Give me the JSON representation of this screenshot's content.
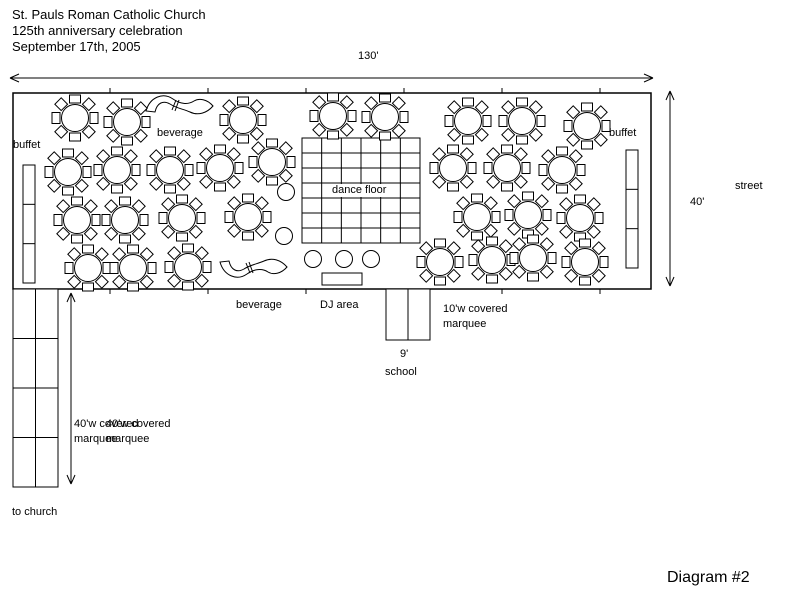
{
  "title": {
    "line1": "St. Pauls Roman Catholic Church",
    "line2": "125th anniversary celebration",
    "line3": "September 17th, 2005"
  },
  "labels": {
    "width_dimension": "130'",
    "height_dimension": "40'",
    "street": "street",
    "buffet_left": "buffet",
    "buffet_right": "buffet",
    "beverage_top": "beverage",
    "beverage_bottom": "beverage",
    "dance_floor": "dance floor",
    "dj_area": "DJ area",
    "marquee10_line1": "10'w covered",
    "marquee10_line2": "marquee",
    "school_width": "9'",
    "school": "school",
    "marquee40_line1": "40'w covered",
    "marquee40_line2": "marquee",
    "to_church": "to church",
    "diagram_number": "Diagram #2"
  },
  "colors": {
    "ink": "#000000",
    "background": "#ffffff"
  },
  "diagram": {
    "main_rect": {
      "x": 13,
      "y": 93,
      "w": 638,
      "h": 196
    },
    "edge_ticks_x": [
      110,
      208,
      306,
      404,
      502,
      600
    ],
    "dance_floor_grid": {
      "x": 302,
      "y": 138,
      "w": 118,
      "h": 105,
      "cols": 6,
      "rows": 7
    },
    "buffet_left_rect": {
      "x": 23,
      "y": 165,
      "w": 12,
      "h": 118,
      "rows": 3,
      "cols": 1
    },
    "buffet_right_rect": {
      "x": 626,
      "y": 150,
      "w": 12,
      "h": 118,
      "rows": 3,
      "cols": 1
    },
    "marquee40_rect": {
      "x": 13,
      "y": 289,
      "w": 45,
      "h": 198,
      "rows": 4,
      "cols": 2
    },
    "school_rect": {
      "x": 386,
      "y": 289,
      "w": 44,
      "h": 51,
      "rows": 1,
      "cols": 2
    },
    "dj_rect": {
      "x": 322,
      "y": 273,
      "w": 40,
      "h": 12
    },
    "tables": [
      [
        75,
        118
      ],
      [
        127,
        122
      ],
      [
        243,
        120
      ],
      [
        333,
        116
      ],
      [
        385,
        117
      ],
      [
        468,
        121
      ],
      [
        522,
        121
      ],
      [
        587,
        126
      ],
      [
        68,
        172
      ],
      [
        117,
        170
      ],
      [
        170,
        170
      ],
      [
        220,
        168
      ],
      [
        272,
        162
      ],
      [
        453,
        168
      ],
      [
        507,
        168
      ],
      [
        562,
        170
      ],
      [
        77,
        220
      ],
      [
        125,
        220
      ],
      [
        182,
        218
      ],
      [
        248,
        217
      ],
      [
        477,
        217
      ],
      [
        528,
        215
      ],
      [
        580,
        218
      ],
      [
        88,
        268
      ],
      [
        133,
        268
      ],
      [
        188,
        267
      ],
      [
        440,
        262
      ],
      [
        492,
        260
      ],
      [
        533,
        258
      ],
      [
        585,
        262
      ]
    ],
    "small_circles": [
      [
        286,
        192
      ],
      [
        284,
        236
      ],
      [
        313,
        259
      ],
      [
        344,
        259
      ],
      [
        371,
        259
      ]
    ],
    "serpentine_path": "M146,111 C150,97 163,92 173,99 C180,104 188,105 194,101 C199,98 207,99 213,106 C207,113 198,116 190,112 C183,109 176,108 170,104 C163,100 157,103 155,112 Z",
    "serpentine_joints": [
      [
        176,
        100,
        172,
        110
      ],
      [
        179,
        100,
        175,
        111
      ]
    ],
    "serpentine_transforms": [
      "",
      "translate(74,373) scale(1,-1)"
    ],
    "arrows": [
      {
        "x1": 10,
        "y1": 78,
        "x2": 653,
        "y2": 78
      },
      {
        "x1": 670,
        "y1": 91,
        "x2": 670,
        "y2": 286
      },
      {
        "x1": 71,
        "y1": 293,
        "x2": 71,
        "y2": 484
      }
    ]
  }
}
